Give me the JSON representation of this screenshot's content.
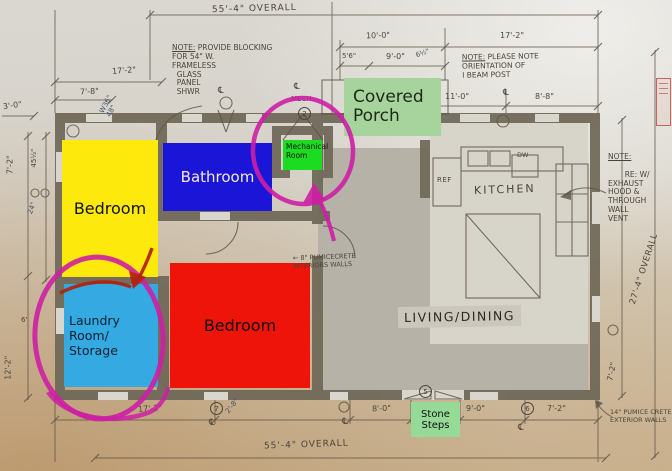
{
  "rooms": {
    "bedroom_left": {
      "label": "Bedroom",
      "color": "#fde90b"
    },
    "bathroom": {
      "label": "Bathroom",
      "color": "#1b15d8",
      "text_color": "#f2ecd4"
    },
    "bedroom_right": {
      "label": "Bedroom",
      "color": "#ee1409"
    },
    "laundry": {
      "label": "Laundry Room/\nStorage",
      "color": "#35a9e1"
    },
    "covered_porch": {
      "label": "Covered\nPorch",
      "color": "#a7d39c"
    },
    "mechanical": {
      "label": "Mechanical\nRoom",
      "color": "#1bdc21"
    },
    "stone_steps": {
      "label": "Stone\nSteps",
      "color": "#95da97"
    },
    "living_dining": {
      "label": "LIVING/DINING",
      "color": "#b6b2a7"
    },
    "kitchen": {
      "label": "KITCHEN",
      "ref_label": "REF",
      "dw_label": "DW",
      "mech_tag": "MECH"
    }
  },
  "dimensions": {
    "overall_top": "55'-4\" OVERALL",
    "overall_bottom": "55'-4\" OVERALL",
    "overall_right": "27'-4\" OVERALL",
    "top_17_2": "17'-2\"",
    "top_7_8": "7'-8\"",
    "top_3_0": "3'-0\"",
    "top_10_0": "10'-0\"",
    "top_5_6": "5'6\"",
    "top_9_0": "9'-0\"",
    "top_6_5": "6½\"",
    "top_17_2_right": "17'-2\"",
    "top_11_0": "11'-0\"",
    "top_8_8": "8'-8\"",
    "left_7_2": "7'-2\"",
    "left_45": "45½\"",
    "left_24": "24\"",
    "left_6": "6'",
    "left_12_2": "12'-2\"",
    "bottom_17_2": "17'-2\"",
    "bottom_2_8": "2'-8\"",
    "bottom_8_0": "8'-0\"",
    "bottom_9_0": "9'-0\"",
    "bottom_7_2": "7'-2\"",
    "right_7_2": "7'-2\""
  },
  "notes": {
    "blocking_title": "NOTE:",
    "blocking_body": " PROVIDE BLOCKING\nFOR 54\" W.\nFRAMELESS\n  GLASS\n  PANEL\n  SHWR",
    "beam_title": "NOTE:",
    "beam_body": " PLEASE NOTE\nORIENTATION OF\nI BEAM POST",
    "exhaust_title": "NOTE:",
    "exhaust_body": "RE: W/\nEXHAUST\nHOOD &\nTHROUGH\nWALL\nVENT",
    "interior_walls": "8\" PUMICECRETE\nINTERIORS WALLS",
    "exterior_walls": "14\" PUMICE CRETE\nEXTERIOR WALLS",
    "window_size": "W36\"\n48\""
  },
  "keynotes": {
    "k2": "2",
    "k5": "5",
    "k6": "6",
    "k7": "7"
  },
  "icons": {
    "centerline": "℄",
    "left_arrow": "←"
  },
  "colors": {
    "annotation_magenta": "#cd1fa4",
    "annotation_red": "#b3200e",
    "pencil": "#4b443a",
    "wall": "#6f6858"
  }
}
